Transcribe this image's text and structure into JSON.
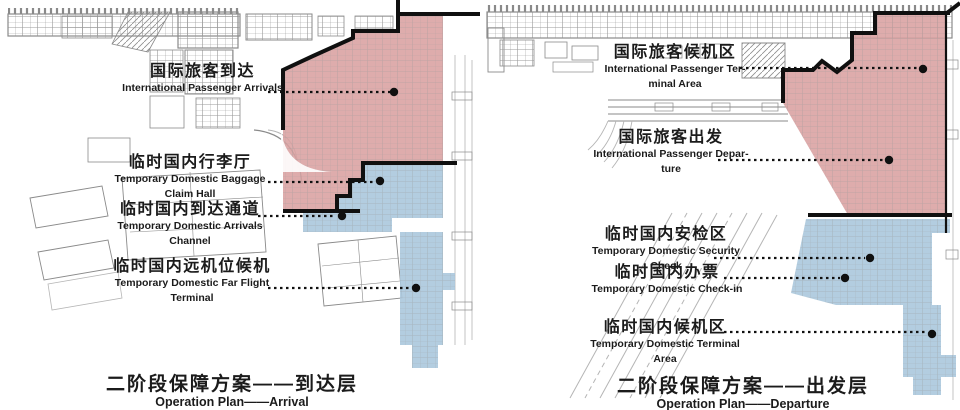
{
  "colors": {
    "red_zone": "#d9a1a1",
    "blue_zone": "#abc8dd",
    "boundary": "#101010",
    "linework": "#8a8a8a",
    "dim_linework": "#b5b5b5",
    "text": "#1b1b1b"
  },
  "left_plan": {
    "labels": [
      {
        "cn": "国际旅客到达",
        "en": [
          "International Passenger Arrivals"
        ]
      },
      {
        "cn": "临时国内行李厅",
        "en": [
          "Temporary Domestic Baggage",
          "Claim Hall"
        ]
      },
      {
        "cn": "临时国内到达通道",
        "en": [
          "Temporary Domestic Arrivals",
          "Channel"
        ]
      },
      {
        "cn": "临时国内远机位候机",
        "en": [
          "Temporary Domestic Far Flight",
          "Terminal"
        ]
      }
    ],
    "caption": {
      "cn": "二阶段保障方案——到达层",
      "en": "Operation Plan——Arrival"
    }
  },
  "right_plan": {
    "labels": [
      {
        "cn": "国际旅客候机区",
        "en": [
          "International Passenger Ter-",
          "minal Area"
        ]
      },
      {
        "cn": "国际旅客出发",
        "en": [
          "International Passenger Depar-",
          "ture"
        ]
      },
      {
        "cn": "临时国内安检区",
        "en": [
          "Temporary Domestic Security",
          "Check"
        ]
      },
      {
        "cn": "临时国内办票",
        "en": [
          "Temporary Domestic Check-in"
        ]
      },
      {
        "cn": "临时国内候机区",
        "en": [
          "Temporary Domestic Terminal",
          "Area"
        ]
      }
    ],
    "caption": {
      "cn": "二阶段保障方案——出发层",
      "en": "Operation Plan——Departure"
    }
  }
}
